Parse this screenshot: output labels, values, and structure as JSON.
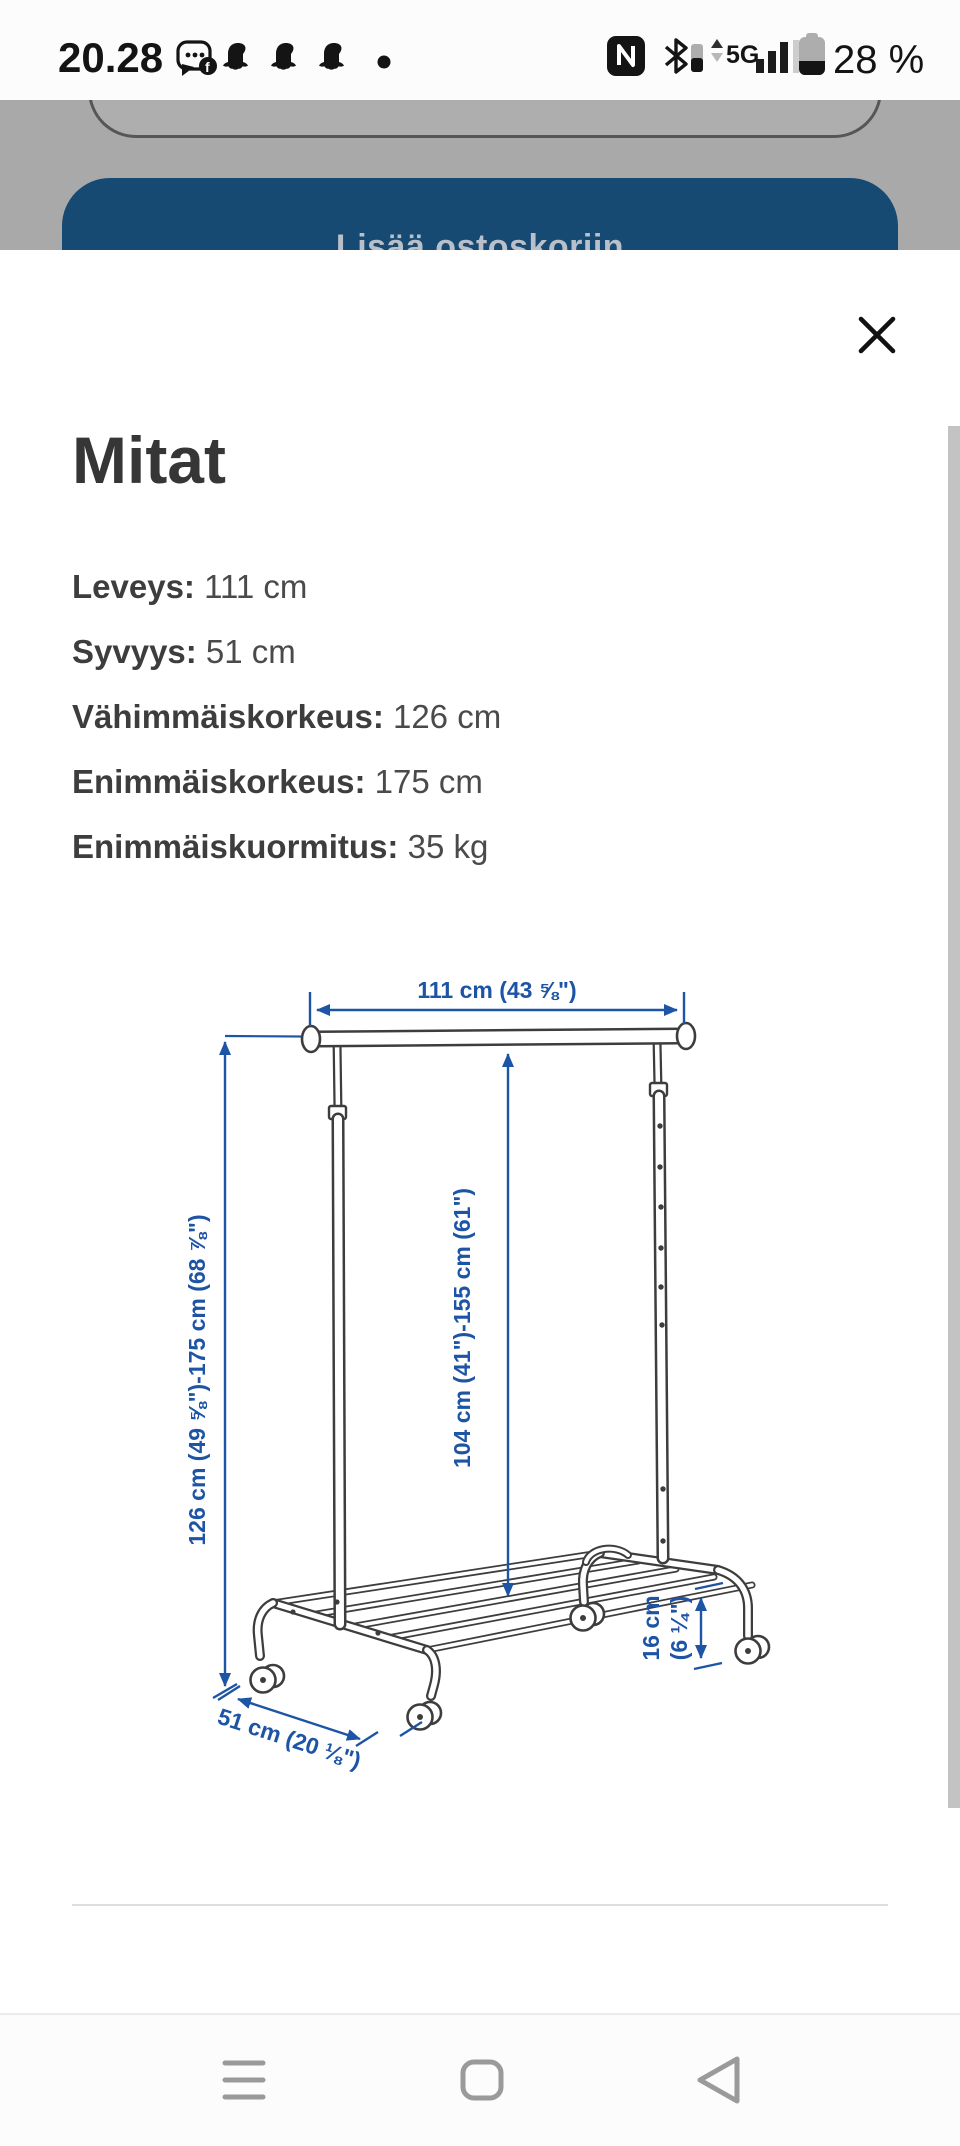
{
  "status_bar": {
    "time": "20.28",
    "network": "5G",
    "battery_percent": "28 %"
  },
  "backdrop": {
    "button_label": "Lisää ostoskoriin"
  },
  "sheet": {
    "title": "Mitat",
    "specs": [
      {
        "label": "Leveys:",
        "value": " 111 cm"
      },
      {
        "label": "Syvyys:",
        "value": " 51 cm"
      },
      {
        "label": "Vähimmäiskorkeus:",
        "value": " 126 cm"
      },
      {
        "label": "Enimmäiskorkeus:",
        "value": " 175 cm"
      },
      {
        "label": "Enimmäiskuormitus:",
        "value": " 35 kg"
      }
    ],
    "diagram": {
      "width_label": "111 cm (43 ⅝\")",
      "height_label": "126 cm (49 ⅝\")-175 cm (68 ⅞\")",
      "rod_height_label": "104 cm (41\")-155 cm (61\")",
      "shelf_clearance_line1": "16 cm",
      "shelf_clearance_line2": "(6 ¼\")",
      "depth_label": "51 cm (20 ⅛\")",
      "accent_color": "#1d54a5"
    }
  }
}
